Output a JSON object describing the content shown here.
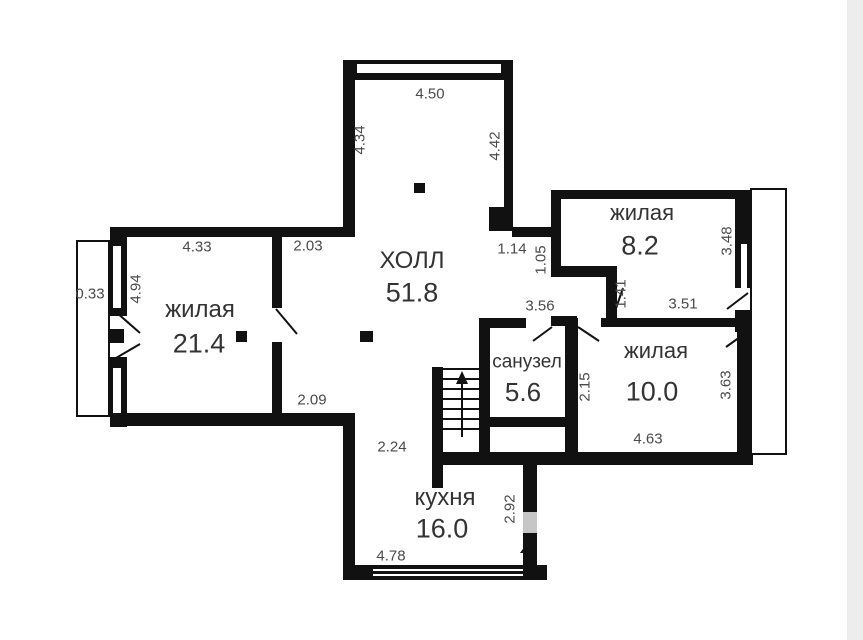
{
  "plan": {
    "rooms": {
      "hall": {
        "name": "ХОЛЛ",
        "area": "51.8"
      },
      "living_left": {
        "name": "жилая",
        "area": "21.4"
      },
      "living_top": {
        "name": "жилая",
        "area": "8.2"
      },
      "living_right": {
        "name": "жилая",
        "area": "10.0"
      },
      "bathroom": {
        "name": "санузел",
        "area": "5.6"
      },
      "kitchen": {
        "name": "кухня",
        "area": "16.0"
      }
    },
    "dims": {
      "hall_top": "4.50",
      "hall_left": "4.34",
      "hall_right": "4.42",
      "niche_width": "1.14",
      "niche_height": "1.05",
      "hall_upper_left": "2.03",
      "living_left_top": "4.33",
      "balcony_left": "0.33",
      "living_left_side": "4.94",
      "living_top_right": "3.48",
      "living_top_door": "1.41",
      "corridor_left": "3.56",
      "corridor_right": "3.51",
      "bathroom_side": "2.15",
      "living_right_side": "3.63",
      "living_right_bottom": "4.63",
      "hall_lower_left": "2.09",
      "kitchen_entry": "2.24",
      "kitchen_side": "2.92",
      "kitchen_bottom": "4.78"
    },
    "colors": {
      "wall": "#111111",
      "dim_text": "#4a4a4a",
      "room_text": "#333333",
      "door_fill": "#c6c6c6",
      "page_edge": "#ededed",
      "background": "#ffffff"
    }
  }
}
